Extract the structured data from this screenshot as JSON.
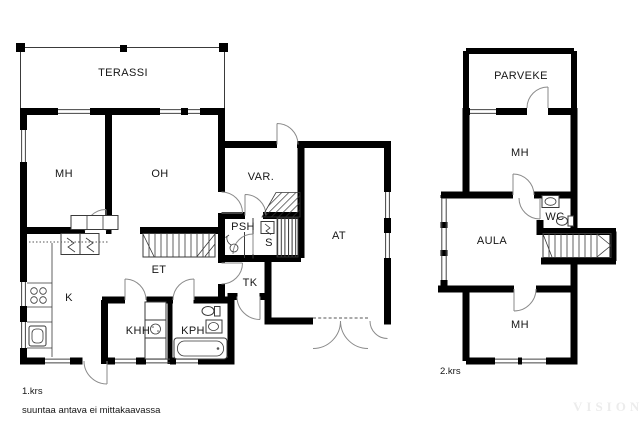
{
  "colors": {
    "wall": "#000000",
    "line": "#3a3a3a",
    "door": "#8a8a8a",
    "text": "#161616",
    "watermark": "#ececec",
    "bg": "#ffffff"
  },
  "floor1": {
    "caption": "1.krs",
    "rooms": {
      "terassi": "TERASSI",
      "mh": "MH",
      "oh": "OH",
      "var": "VAR.",
      "psh": "PSH",
      "s": "S",
      "at": "AT",
      "et": "ET",
      "tk": "TK",
      "k": "K",
      "khh": "KHH",
      "kph": "KPH"
    }
  },
  "floor2": {
    "caption": "2.krs",
    "rooms": {
      "parveke": "PARVEKE",
      "mh_top": "MH",
      "wc": "WC",
      "aula": "AULA",
      "mh_bottom": "MH"
    }
  },
  "footer": {
    "disclaimer": "suuntaa antava ei mittakaavassa"
  },
  "watermark": {
    "text": "VISION"
  }
}
